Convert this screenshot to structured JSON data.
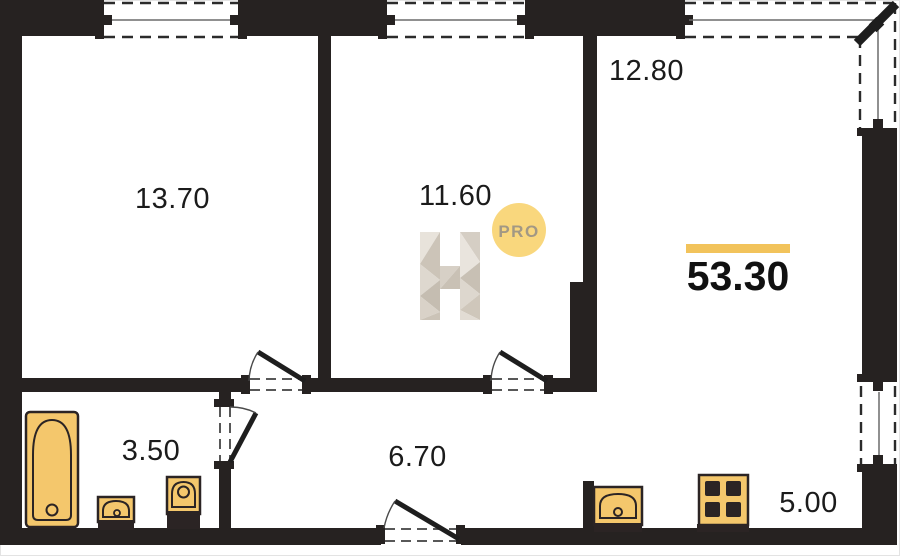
{
  "plan": {
    "total_area": "53.30",
    "rooms": [
      {
        "name": "bedroom",
        "area": "13.70"
      },
      {
        "name": "room",
        "area": "11.60"
      },
      {
        "name": "living-area",
        "area": "12.80"
      },
      {
        "name": "bathroom",
        "area": "3.50"
      },
      {
        "name": "hallway",
        "area": "6.70"
      },
      {
        "name": "kitchen",
        "area": "5.00"
      }
    ],
    "logo": {
      "letter": "H",
      "badge": "PRO"
    },
    "fixtures": [
      "bathtub",
      "washbasin",
      "toilet",
      "kitchen-sink",
      "stove"
    ],
    "colors": {
      "wall": "#262221",
      "fixture_fill": "#F4C76C",
      "fixture_border": "#2B2424",
      "accent_bar": "#F2C35B",
      "badge_bg": "#F9D77D",
      "badge_text": "#A29884",
      "label_text": "#1B1B1B"
    }
  }
}
